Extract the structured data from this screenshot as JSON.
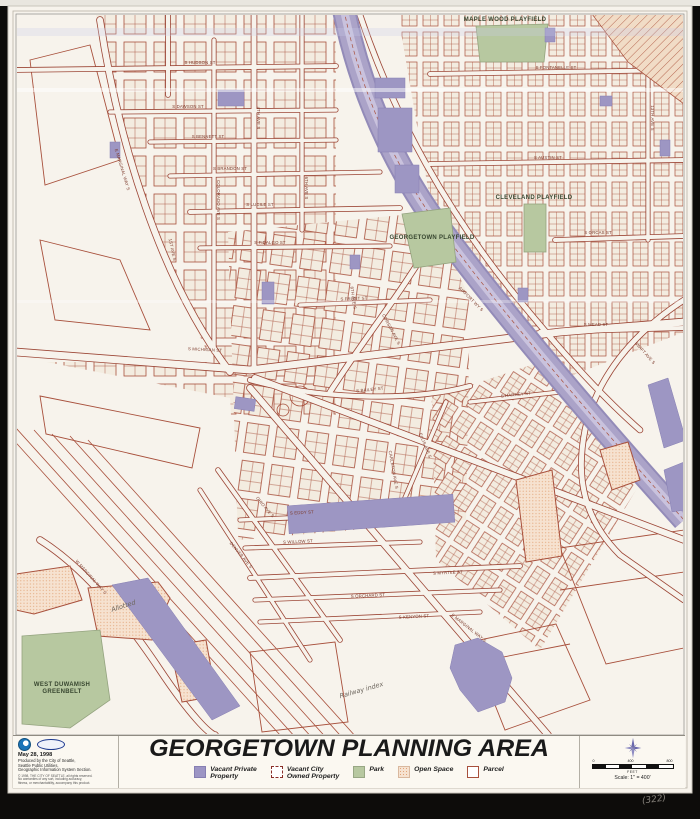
{
  "title": {
    "text": "GEORGETOWN PLANNING AREA"
  },
  "legend": {
    "items": [
      {
        "label": "Vacant Private\nProperty",
        "swatch": "vacant-private"
      },
      {
        "label": "Vacant City\nOwned Property",
        "swatch": "vacant-city"
      },
      {
        "label": "Park",
        "swatch": "park"
      },
      {
        "label": "Open Space",
        "swatch": "open-space"
      },
      {
        "label": "Parcel",
        "swatch": "parcel"
      }
    ]
  },
  "info": {
    "date": "May 28, 1998",
    "credit_lines": [
      "Produced by the City of Seattle,",
      "Seattle Public Utilities,",
      "Geographic Information System Section."
    ],
    "fine_print": [
      "© 1998, THE CITY OF SEATTLE, all rights reserved.",
      "No warranties of any sort, including accuracy,",
      "fitness, or merchantability, accompany this product."
    ]
  },
  "scale": {
    "tick_labels": [
      "0",
      "400",
      "800"
    ],
    "unit": "FEET",
    "text": "Scale: 1\" = 400'"
  },
  "pencil_note": "(322)",
  "colors": {
    "sheet": "#f7f3ec",
    "parcel_line": "#a8503c",
    "vacant_private": "#9d96c3",
    "park": "#b7c8a0",
    "open_space": "#f6e2d0",
    "corridor": "#aba3c8",
    "accent_title": "#1a1a1a"
  },
  "map": {
    "area_labels": [
      {
        "text": "MAPLE WOOD PLAYFIELD",
        "x": 505,
        "y": 21,
        "size": 5.2
      },
      {
        "text": "CLEVELAND PLAYFIELD",
        "x": 534,
        "y": 199,
        "size": 5.4
      },
      {
        "text": "GEORGETOWN PLAYFIELD",
        "x": 432,
        "y": 239,
        "size": 5.4
      },
      {
        "text": "WEST DUWAMISH",
        "x": 62,
        "y": 686,
        "size": 5.6
      },
      {
        "text": "GREENBELT",
        "x": 62,
        "y": 693,
        "size": 5.6
      }
    ],
    "street_labels": [
      {
        "t": "E MARGINAL WAY S",
        "x": 121,
        "y": 170,
        "r": 73
      },
      {
        "t": "COLORADO AVE S",
        "x": 217,
        "y": 200,
        "r": 90
      },
      {
        "t": "1ST AVE S",
        "x": 171,
        "y": 250,
        "r": 78
      },
      {
        "t": "4TH AVE S",
        "x": 257,
        "y": 118,
        "r": 90
      },
      {
        "t": "6TH AVE S",
        "x": 305,
        "y": 188,
        "r": 90
      },
      {
        "t": "8TH AVE S",
        "x": 352,
        "y": 298,
        "r": 82
      },
      {
        "t": "S HUDSON ST",
        "x": 200,
        "y": 64,
        "r": 0
      },
      {
        "t": "S DAWSON ST",
        "x": 188,
        "y": 108,
        "r": 0
      },
      {
        "t": "S BENNETT ST",
        "x": 208,
        "y": 138,
        "r": 0
      },
      {
        "t": "S BRANDON ST",
        "x": 230,
        "y": 170,
        "r": 0
      },
      {
        "t": "S LUCILE ST",
        "x": 260,
        "y": 206,
        "r": 0
      },
      {
        "t": "S FIDALGO ST",
        "x": 270,
        "y": 244,
        "r": 0
      },
      {
        "t": "S FRONT ST",
        "x": 354,
        "y": 300,
        "r": -2
      },
      {
        "t": "S MICHIGAN ST",
        "x": 205,
        "y": 351,
        "r": 3
      },
      {
        "t": "S BAILEY ST",
        "x": 370,
        "y": 391,
        "r": -6
      },
      {
        "t": "S FONTANELLE ST",
        "x": 556,
        "y": 69,
        "r": 0
      },
      {
        "t": "S AUSTIN ST",
        "x": 548,
        "y": 159,
        "r": 0
      },
      {
        "t": "S ORCAS ST",
        "x": 598,
        "y": 234,
        "r": 0
      },
      {
        "t": "S MEAD ST",
        "x": 596,
        "y": 326,
        "r": 0
      },
      {
        "t": "S HARNEY ST",
        "x": 516,
        "y": 396,
        "r": -6
      },
      {
        "t": "CORSON AVE S",
        "x": 390,
        "y": 330,
        "r": 62
      },
      {
        "t": "AIRPORT WY S",
        "x": 470,
        "y": 300,
        "r": 45
      },
      {
        "t": "SWIFT AVE S",
        "x": 644,
        "y": 354,
        "r": 48
      },
      {
        "t": "ELLIS AVE S",
        "x": 424,
        "y": 446,
        "r": 68
      },
      {
        "t": "CARLETON AVE S",
        "x": 392,
        "y": 470,
        "r": 80
      },
      {
        "t": "OHIO AVE S",
        "x": 264,
        "y": 508,
        "r": 50
      },
      {
        "t": "DENVER AVE S",
        "x": 240,
        "y": 556,
        "r": 50
      },
      {
        "t": "S EDDY ST",
        "x": 302,
        "y": 514,
        "r": -3
      },
      {
        "t": "S WILLOW ST",
        "x": 298,
        "y": 543,
        "r": -3
      },
      {
        "t": "S MYRTLE ST",
        "x": 448,
        "y": 574,
        "r": -3
      },
      {
        "t": "S ORCHARD ST",
        "x": 368,
        "y": 597,
        "r": -3
      },
      {
        "t": "S KENYON ST",
        "x": 414,
        "y": 618,
        "r": -3
      },
      {
        "t": "E MARGINAL WAY S",
        "x": 468,
        "y": 629,
        "r": 38
      },
      {
        "t": "W MARGINAL WAY S",
        "x": 90,
        "y": 578,
        "r": 48
      },
      {
        "t": "13TH AVE S",
        "x": 651,
        "y": 118,
        "r": 90
      }
    ],
    "handwriting": [
      {
        "text": "Allotted",
        "x": 124,
        "y": 608,
        "r": -18
      },
      {
        "text": "Railway index",
        "x": 362,
        "y": 692,
        "r": -16
      }
    ]
  }
}
